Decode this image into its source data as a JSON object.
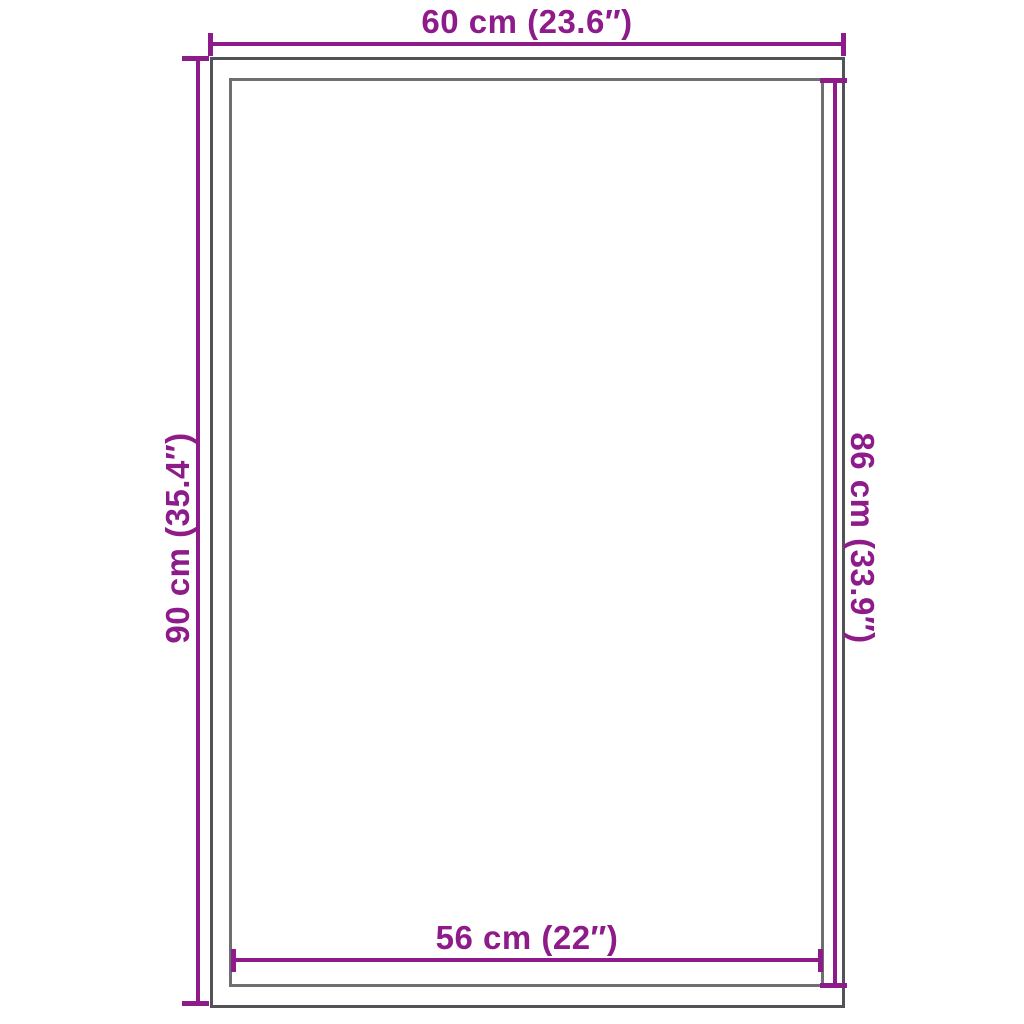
{
  "diagram": {
    "colors": {
      "accent": "#8E1B8A",
      "outer_rectangle_border": "#525356",
      "inner_rectangle_border": "#6E6F72",
      "background": "#FFFFFF"
    },
    "dimensions": {
      "top": "60 cm (23.6″)",
      "left": "90 cm (35.4″)",
      "right": "86 cm (33.9″)",
      "bottom": "56 cm (22″)"
    }
  }
}
